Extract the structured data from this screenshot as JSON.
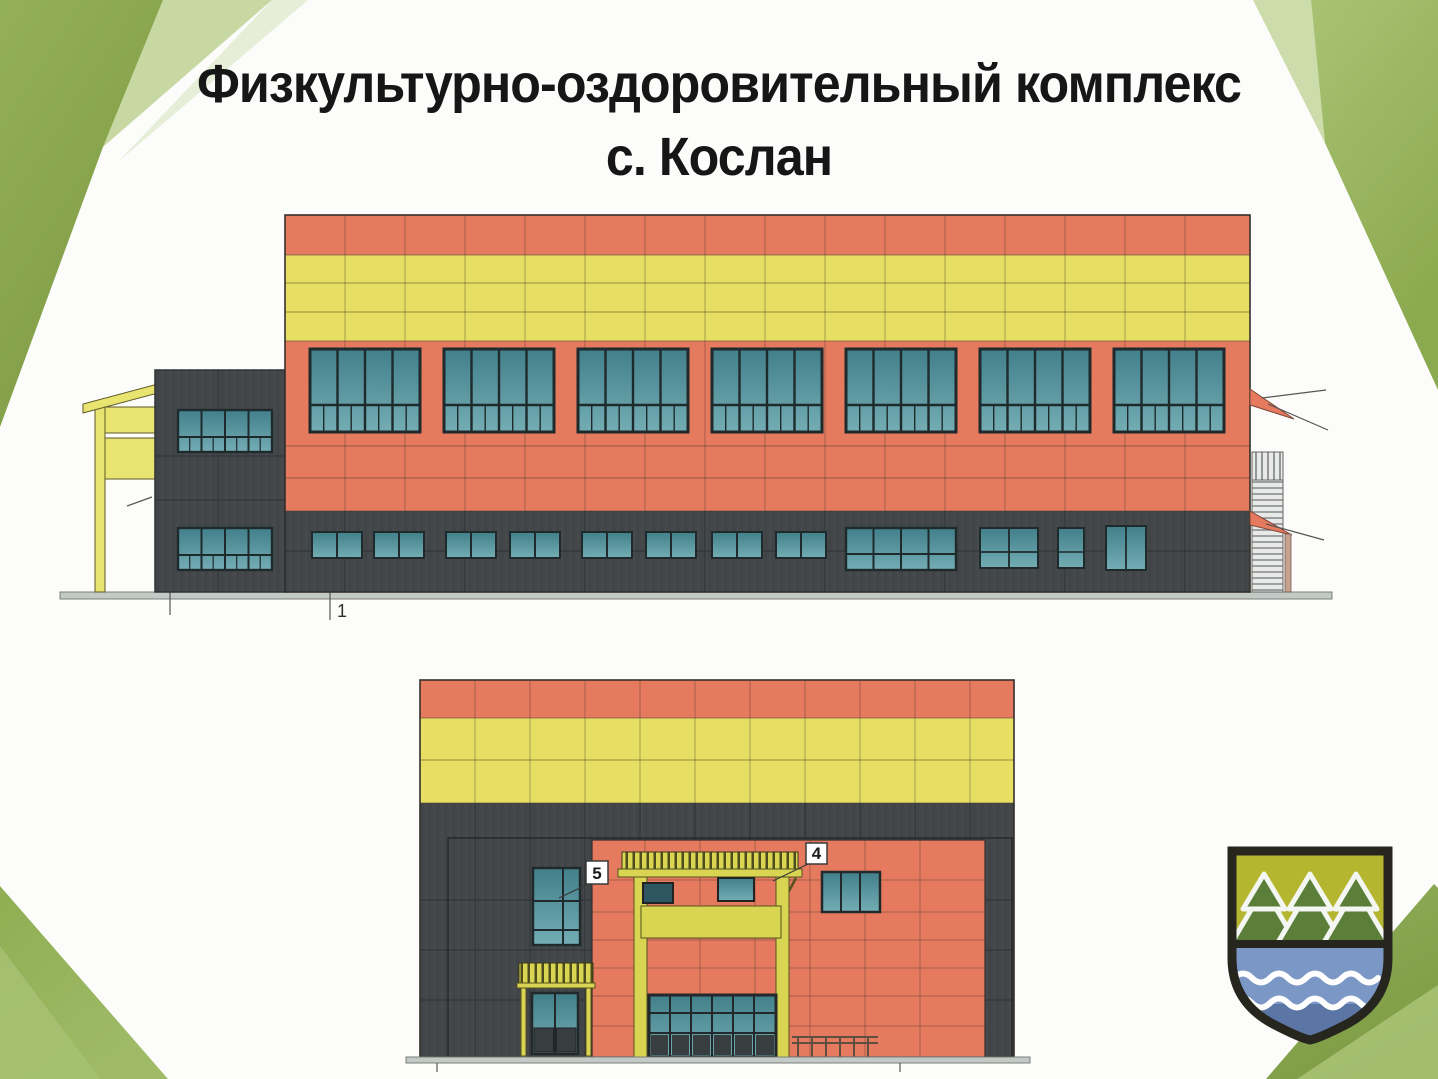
{
  "slide": {
    "background_color": "#fcfcfb",
    "title": {
      "line1": "Физкультурно-оздоровительный комплекс",
      "line2": "с. Кослан"
    }
  },
  "drawings": {
    "side_elevation": {
      "axis_marker": "1"
    },
    "front_elevation": {
      "callout_5": "5",
      "callout_4": "4"
    }
  },
  "palette": {
    "facade_orange": "#e57a5f",
    "facade_yellow": "#e6df64",
    "facade_dark_gray": "#43474a",
    "glass_teal_top": "#417f8a",
    "glass_teal_bottom": "#74adb4",
    "trim_yellow": "#d9d452",
    "porch_yellow": "#e9e36f",
    "decor_green_dark": "#84a148",
    "decor_green_medium": "#9ab85f",
    "decor_green_light": "#c7d8a3",
    "emblem_olive": "#b5b62f",
    "emblem_tree_green": "#5b7f39",
    "emblem_water_blue": "#7b97c6",
    "emblem_water_blue_dark": "#5b76a4",
    "emblem_border": "#26261f"
  },
  "icons": {
    "emblem": "koslan-coat-of-arms",
    "emblem_top": "fir-trees-icon",
    "emblem_bottom": "river-waves-icon"
  }
}
